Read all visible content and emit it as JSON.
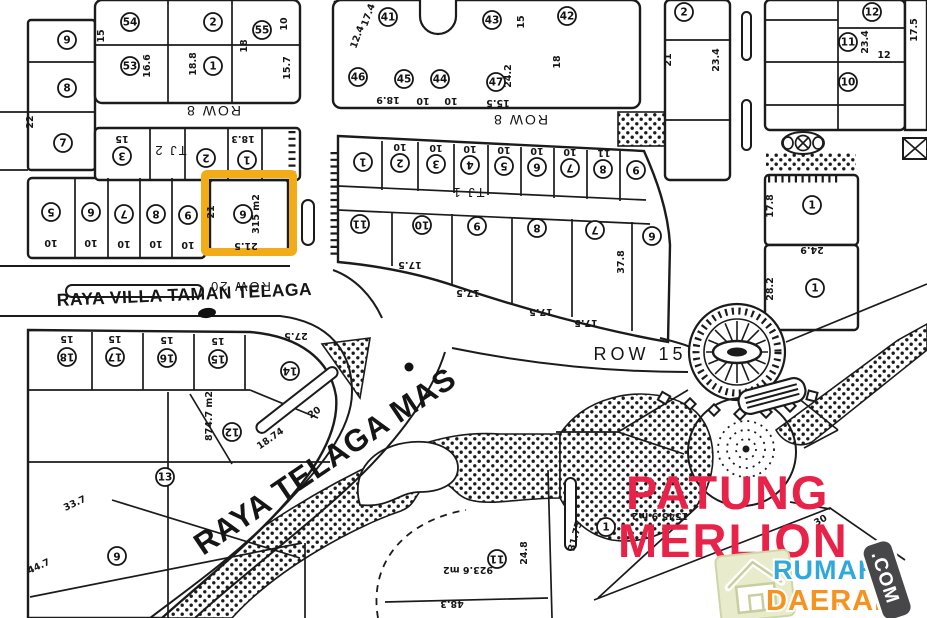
{
  "map": {
    "background": "#ffffff",
    "line_color": "#1b1b1b",
    "road_labels": {
      "row8_left": "ROW 8",
      "row8_center": "ROW 8",
      "row20": "ROW 20",
      "row15": "ROW 15",
      "tj1": "TJ 1",
      "tj2": "TJ 2",
      "raya_villa": "RAYA VILLA TAMAN TELAGA",
      "raya_mas": "RAYA TELAGA MAS"
    },
    "highlight": {
      "color": "#F2AC18"
    },
    "landmark": {
      "line1": "PATUNG",
      "line2": "MERLION",
      "color": "#E72349"
    },
    "watermark": {
      "word1": "RUMAH",
      "word2": "DAERAH",
      "tld": ".COM",
      "blue": "#2FA8DC",
      "orange": "#F6921E",
      "badge": "#474749",
      "tile": "#E9EBCD"
    },
    "parcel_circles": [
      {
        "n": "9",
        "x": 67,
        "y": 40,
        "r": 0
      },
      {
        "n": "8",
        "x": 67,
        "y": 88,
        "r": 0
      },
      {
        "n": "7",
        "x": 63,
        "y": 143,
        "r": 0
      },
      {
        "n": "54",
        "x": 130,
        "y": 22,
        "r": 0
      },
      {
        "n": "53",
        "x": 130,
        "y": 66,
        "r": 0
      },
      {
        "n": "2",
        "x": 213,
        "y": 22,
        "r": 0
      },
      {
        "n": "1",
        "x": 213,
        "y": 66,
        "r": 0
      },
      {
        "n": "55",
        "x": 262,
        "y": 30,
        "r": 0
      },
      {
        "n": "3",
        "x": 122,
        "y": 156,
        "r": 180
      },
      {
        "n": "2",
        "x": 206,
        "y": 158,
        "r": 180
      },
      {
        "n": "1",
        "x": 247,
        "y": 160,
        "r": 180
      },
      {
        "n": "5",
        "x": 51,
        "y": 212,
        "r": 180
      },
      {
        "n": "6",
        "x": 91,
        "y": 212,
        "r": 180
      },
      {
        "n": "7",
        "x": 124,
        "y": 214,
        "r": 180
      },
      {
        "n": "8",
        "x": 156,
        "y": 214,
        "r": 180
      },
      {
        "n": "9",
        "x": 188,
        "y": 215,
        "r": 180
      },
      {
        "n": "6",
        "x": 243,
        "y": 214,
        "r": 180
      },
      {
        "n": "41",
        "x": 388,
        "y": 17,
        "r": 0
      },
      {
        "n": "43",
        "x": 492,
        "y": 20,
        "r": 0
      },
      {
        "n": "42",
        "x": 567,
        "y": 16,
        "r": 0
      },
      {
        "n": "46",
        "x": 358,
        "y": 77,
        "r": 0
      },
      {
        "n": "45",
        "x": 404,
        "y": 79,
        "r": 0
      },
      {
        "n": "44",
        "x": 440,
        "y": 79,
        "r": 0
      },
      {
        "n": "47",
        "x": 496,
        "y": 82,
        "r": 0
      },
      {
        "n": "1",
        "x": 363,
        "y": 162,
        "r": 180
      },
      {
        "n": "2",
        "x": 400,
        "y": 163,
        "r": 180
      },
      {
        "n": "3",
        "x": 436,
        "y": 164,
        "r": 180
      },
      {
        "n": "4",
        "x": 470,
        "y": 165,
        "r": 180
      },
      {
        "n": "5",
        "x": 504,
        "y": 166,
        "r": 180
      },
      {
        "n": "6",
        "x": 537,
        "y": 167,
        "r": 180
      },
      {
        "n": "7",
        "x": 570,
        "y": 168,
        "r": 180
      },
      {
        "n": "8",
        "x": 603,
        "y": 169,
        "r": 180
      },
      {
        "n": "9",
        "x": 636,
        "y": 170,
        "r": 180
      },
      {
        "n": "11",
        "x": 360,
        "y": 224,
        "r": 180
      },
      {
        "n": "10",
        "x": 422,
        "y": 225,
        "r": 180
      },
      {
        "n": "9",
        "x": 477,
        "y": 226,
        "r": 180
      },
      {
        "n": "8",
        "x": 537,
        "y": 228,
        "r": 180
      },
      {
        "n": "7",
        "x": 595,
        "y": 230,
        "r": 180
      },
      {
        "n": "6",
        "x": 652,
        "y": 236,
        "r": 180
      },
      {
        "n": "2",
        "x": 684,
        "y": 12,
        "r": 0
      },
      {
        "n": "12",
        "x": 872,
        "y": 12,
        "r": 0
      },
      {
        "n": "11",
        "x": 848,
        "y": 42,
        "r": 0
      },
      {
        "n": "10",
        "x": 848,
        "y": 82,
        "r": 0
      },
      {
        "n": "1",
        "x": 812,
        "y": 205,
        "r": 0
      },
      {
        "n": "1",
        "x": 815,
        "y": 288,
        "r": 0
      },
      {
        "n": "18",
        "x": 67,
        "y": 357,
        "r": 180
      },
      {
        "n": "17",
        "x": 115,
        "y": 357,
        "r": 180
      },
      {
        "n": "16",
        "x": 167,
        "y": 358,
        "r": 180
      },
      {
        "n": "15",
        "x": 218,
        "y": 359,
        "r": 180
      },
      {
        "n": "14",
        "x": 290,
        "y": 371,
        "r": 180
      },
      {
        "n": "12",
        "x": 232,
        "y": 432,
        "r": 180
      },
      {
        "n": "13",
        "x": 165,
        "y": 477,
        "r": 0
      },
      {
        "n": "6",
        "x": 117,
        "y": 556,
        "r": 180
      },
      {
        "n": "11",
        "x": 497,
        "y": 559,
        "r": 180
      },
      {
        "n": "1",
        "x": 606,
        "y": 527,
        "r": 0
      }
    ],
    "measurements": [
      {
        "t": "22",
        "x": 33,
        "y": 122,
        "r": -90
      },
      {
        "t": "15",
        "x": 104,
        "y": 36,
        "r": -90
      },
      {
        "t": "16.6",
        "x": 150,
        "y": 66,
        "r": -90
      },
      {
        "t": "18.8",
        "x": 196,
        "y": 64,
        "r": -90
      },
      {
        "t": "10",
        "x": 287,
        "y": 24,
        "r": -90
      },
      {
        "t": "15.7",
        "x": 290,
        "y": 68,
        "r": -90
      },
      {
        "t": "18",
        "x": 247,
        "y": 46,
        "r": -90
      },
      {
        "t": "15",
        "x": 122,
        "y": 136,
        "r": 180
      },
      {
        "t": "18.3",
        "x": 243,
        "y": 136,
        "r": 180
      },
      {
        "t": "10",
        "x": 51,
        "y": 240,
        "r": 180
      },
      {
        "t": "10",
        "x": 91,
        "y": 240,
        "r": 180
      },
      {
        "t": "10",
        "x": 124,
        "y": 241,
        "r": 180
      },
      {
        "t": "10",
        "x": 156,
        "y": 241,
        "r": 180
      },
      {
        "t": "10",
        "x": 188,
        "y": 242,
        "r": 180
      },
      {
        "t": "21",
        "x": 214,
        "y": 212,
        "r": -90
      },
      {
        "t": "315 m2",
        "x": 259,
        "y": 214,
        "r": -90
      },
      {
        "t": "21.5",
        "x": 246,
        "y": 243,
        "r": 180
      },
      {
        "t": "17.4",
        "x": 371,
        "y": 16,
        "r": -70
      },
      {
        "t": "12.4",
        "x": 360,
        "y": 38,
        "r": -70
      },
      {
        "t": "15",
        "x": 524,
        "y": 22,
        "r": -90
      },
      {
        "t": "24.2",
        "x": 511,
        "y": 76,
        "r": -90
      },
      {
        "t": "18",
        "x": 560,
        "y": 62,
        "r": -90
      },
      {
        "t": "18.9",
        "x": 388,
        "y": 97,
        "r": 180
      },
      {
        "t": "10",
        "x": 423,
        "y": 98,
        "r": 180
      },
      {
        "t": "10",
        "x": 451,
        "y": 98,
        "r": 180
      },
      {
        "t": "15.5",
        "x": 498,
        "y": 100,
        "r": 180
      },
      {
        "t": "10",
        "x": 400,
        "y": 144,
        "r": 180
      },
      {
        "t": "10",
        "x": 436,
        "y": 145,
        "r": 180
      },
      {
        "t": "10",
        "x": 470,
        "y": 146,
        "r": 180
      },
      {
        "t": "10",
        "x": 504,
        "y": 147,
        "r": 180
      },
      {
        "t": "10",
        "x": 537,
        "y": 148,
        "r": 180
      },
      {
        "t": "10",
        "x": 570,
        "y": 149,
        "r": 180
      },
      {
        "t": "11",
        "x": 604,
        "y": 150,
        "r": 180
      },
      {
        "t": "17.5",
        "x": 410,
        "y": 262,
        "r": 180
      },
      {
        "t": "17.5",
        "x": 468,
        "y": 290,
        "r": 180
      },
      {
        "t": "17.5",
        "x": 541,
        "y": 309,
        "r": 180
      },
      {
        "t": "17.5",
        "x": 586,
        "y": 320,
        "r": 180
      },
      {
        "t": "37.8",
        "x": 624,
        "y": 262,
        "r": -90
      },
      {
        "t": "21",
        "x": 671,
        "y": 60,
        "r": -90
      },
      {
        "t": "23.4",
        "x": 719,
        "y": 60,
        "r": -90
      },
      {
        "t": "23.4",
        "x": 868,
        "y": 42,
        "r": -90
      },
      {
        "t": "12",
        "x": 884,
        "y": 58,
        "r": 0
      },
      {
        "t": "17.5",
        "x": 917,
        "y": 30,
        "r": -90
      },
      {
        "t": "17.8",
        "x": 773,
        "y": 206,
        "r": -90
      },
      {
        "t": "24.9",
        "x": 812,
        "y": 247,
        "r": 180
      },
      {
        "t": "28.2",
        "x": 773,
        "y": 289,
        "r": -90
      },
      {
        "t": "15",
        "x": 67,
        "y": 336,
        "r": 180
      },
      {
        "t": "15",
        "x": 115,
        "y": 336,
        "r": 180
      },
      {
        "t": "15",
        "x": 167,
        "y": 337,
        "r": 180
      },
      {
        "t": "15",
        "x": 218,
        "y": 338,
        "r": 180
      },
      {
        "t": "27.5",
        "x": 296,
        "y": 333,
        "r": 180
      },
      {
        "t": "874.7 m2",
        "x": 212,
        "y": 416,
        "r": -90
      },
      {
        "t": "20",
        "x": 316,
        "y": 415,
        "r": -35
      },
      {
        "t": "18.74",
        "x": 272,
        "y": 441,
        "r": -35
      },
      {
        "t": "33.7",
        "x": 76,
        "y": 506,
        "r": -25
      },
      {
        "t": "44.7",
        "x": 40,
        "y": 569,
        "r": -25
      },
      {
        "t": "923.6 m2",
        "x": 468,
        "y": 567,
        "r": 180
      },
      {
        "t": "48.3",
        "x": 452,
        "y": 601,
        "r": 180
      },
      {
        "t": "24.8",
        "x": 527,
        "y": 553,
        "r": -90
      },
      {
        "t": "31.75",
        "x": 578,
        "y": 537,
        "r": -75
      },
      {
        "t": "1545.9 m2",
        "x": 660,
        "y": 513,
        "r": 180
      },
      {
        "t": "30",
        "x": 822,
        "y": 523,
        "r": -30
      }
    ]
  }
}
